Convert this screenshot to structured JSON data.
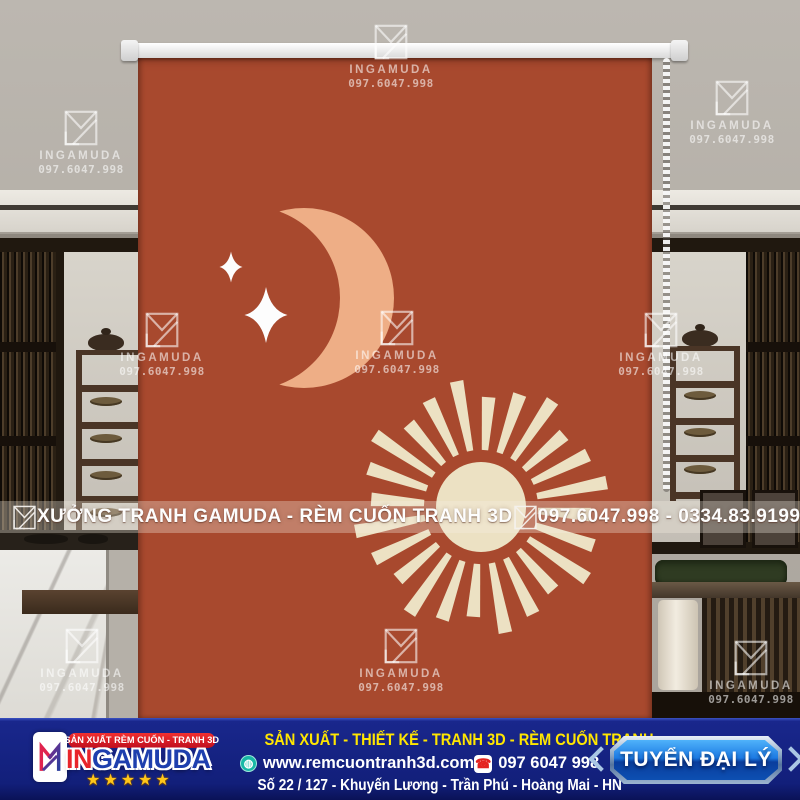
{
  "watermark": {
    "brand": "INGAMUDA",
    "phone": "097.6047.998"
  },
  "banner": {
    "workshop_label": "XƯỞNG TRANH GAMUDA - RÈM CUỐN TRANH 3D",
    "hotline_label": "097.6047.998 - 0334.83.9199"
  },
  "footer": {
    "ribbon_label": "SẢN XUẤT RÈM CUỐN - TRANH 3D",
    "brand_prefix": "IN",
    "brand_suffix": "GAMUDA",
    "rating_stars": "★★★★★",
    "services_line": "SẢN XUẤT - THIẾT KẾ - TRANH 3D - RÈM CUỐN TRANH",
    "website": "www.remcuontranh3d.com",
    "hotline": "097 6047 998",
    "address": "Số 22 / 127 - Khuyến Lương - Trần Phú - Hoàng Mai - HN",
    "cta_label": "TUYỂN ĐẠI LÝ",
    "globe_glyph": "◍",
    "phone_glyph": "☎"
  },
  "colors": {
    "blind": "#a8492e",
    "moon": "#eeae86",
    "sun_cream": "#ece1c3",
    "star_white": "#fdfdfd",
    "footer_bg": "#121f7a",
    "accent_yellow": "#ffe600",
    "cta_blue": "#1c7ae3",
    "ribbon_red": "#d61c24",
    "brand_red": "#e8252b",
    "brand_blue": "#1e3fae",
    "star_gold": "#ffc61a",
    "globe_teal": "#18b8a6",
    "phone_red": "#e42320"
  }
}
